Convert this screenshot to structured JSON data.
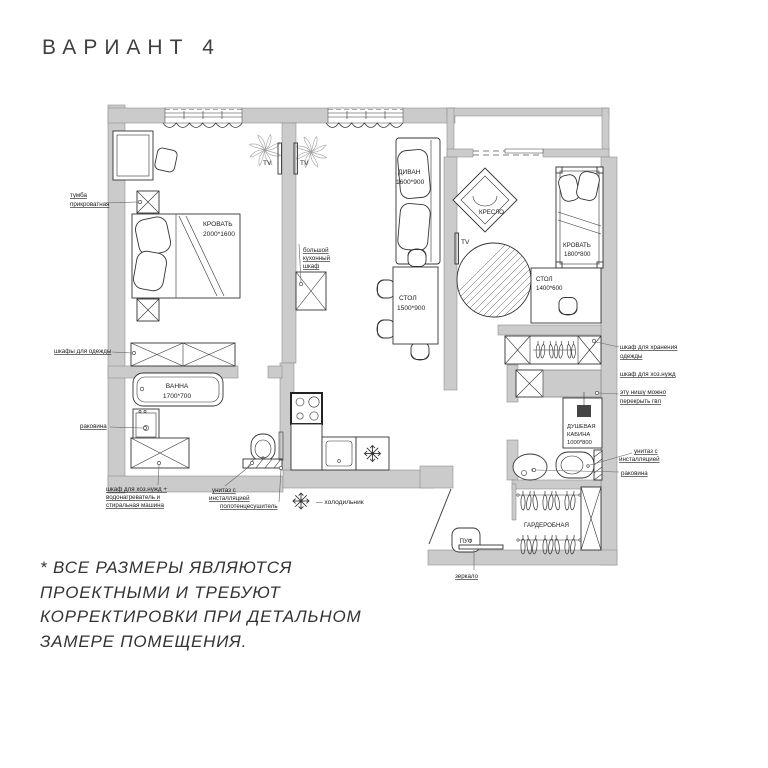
{
  "title": "ВАРИАНТ 4",
  "note": {
    "l1": "* ВСЕ РАЗМЕРЫ ЯВЛЯЮТСЯ",
    "l2": "ПРОЕКТНЫМИ И ТРЕБУЮТ",
    "l3": "КОРРЕКТИРОВКИ ПРИ ДЕТАЛЬНОМ",
    "l4": "ЗАМЕРЕ ПОМЕЩЕНИЯ."
  },
  "legend": {
    "fridge": "—  холодильник"
  },
  "rooms": {
    "bed1": {
      "name": "КРОВАТЬ",
      "size": "2000*1600"
    },
    "bed2": {
      "name": "КРОВАТЬ",
      "size": "1800*800"
    },
    "sofa": {
      "name": "ДИВАН",
      "size": "1600*900"
    },
    "armchair": "КРЕСЛО",
    "dining": {
      "name": "СТОЛ",
      "size": "1500*900"
    },
    "desk2": {
      "name": "СТОЛ",
      "size": "1400*600"
    },
    "bath": {
      "name": "ВАННА",
      "size": "1700*700"
    },
    "shower": {
      "l1": "ДУШЕВАЯ",
      "l2": "КАБИНА",
      "l3": "1000*800"
    },
    "closet": "ГАРДЕРОБНАЯ",
    "pouf": "ПУФ",
    "tv": "TV",
    "kitchen_cabinet": {
      "l1": "большой",
      "l2": "кухонный",
      "l3": "шкаф"
    }
  },
  "callouts": {
    "nightstand": {
      "l1": "тумба",
      "l2": "прикроватная"
    },
    "wardrobes": "шкафы для одежды",
    "sink1": "раковина",
    "utility": {
      "l1": "шкаф для хоз.нужд +",
      "l2": "водонагреватель и",
      "l3": "стиральная машина"
    },
    "toilet1": {
      "l1": "унитаз с",
      "l2": "инсталляцией"
    },
    "towel": "полотенцесушитель",
    "storage": {
      "l1": "шкаф для хранения",
      "l2": "одежды"
    },
    "utility2": "шкаф для хоз.нужд",
    "niche": {
      "l1": "эту нишу можно",
      "l2": "перекрыть гвл"
    },
    "toilet2": {
      "l1": "унитаз с",
      "l2": "инсталляцией"
    },
    "sink2": "раковина",
    "mirror": "зеркало"
  }
}
